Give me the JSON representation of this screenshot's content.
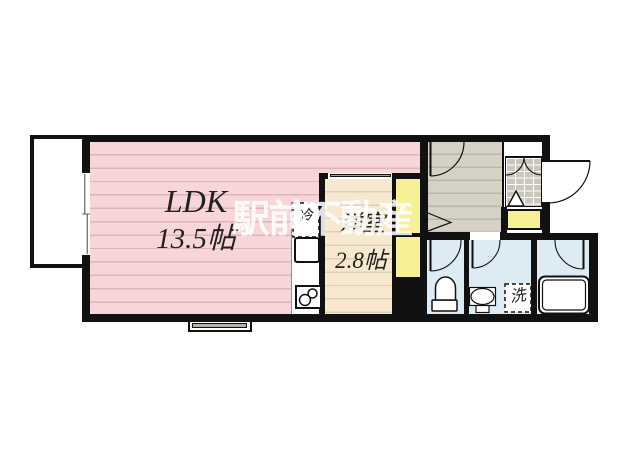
{
  "document": {
    "type": "apartment floor plan"
  },
  "watermark": {
    "text": "駅前不動産"
  },
  "rooms": {
    "ldk": {
      "label": "LDK",
      "size": "13.5帖"
    },
    "western_room": {
      "label": "洋室",
      "size": "2.8帖"
    }
  },
  "fixtures": {
    "refrigerator_label": "冷",
    "washer_label": "洗"
  },
  "colors": {
    "wall": "#111111",
    "ldk_pink": "#f8d5d8",
    "room_cream": "#f6e9d0",
    "hall_gray": "#d5d1c4",
    "wet_blue": "#ddecf4",
    "closet_yellow": "#f6f096",
    "tile_gray": "#c9c6bc",
    "watermark_white": "#ffffff"
  }
}
